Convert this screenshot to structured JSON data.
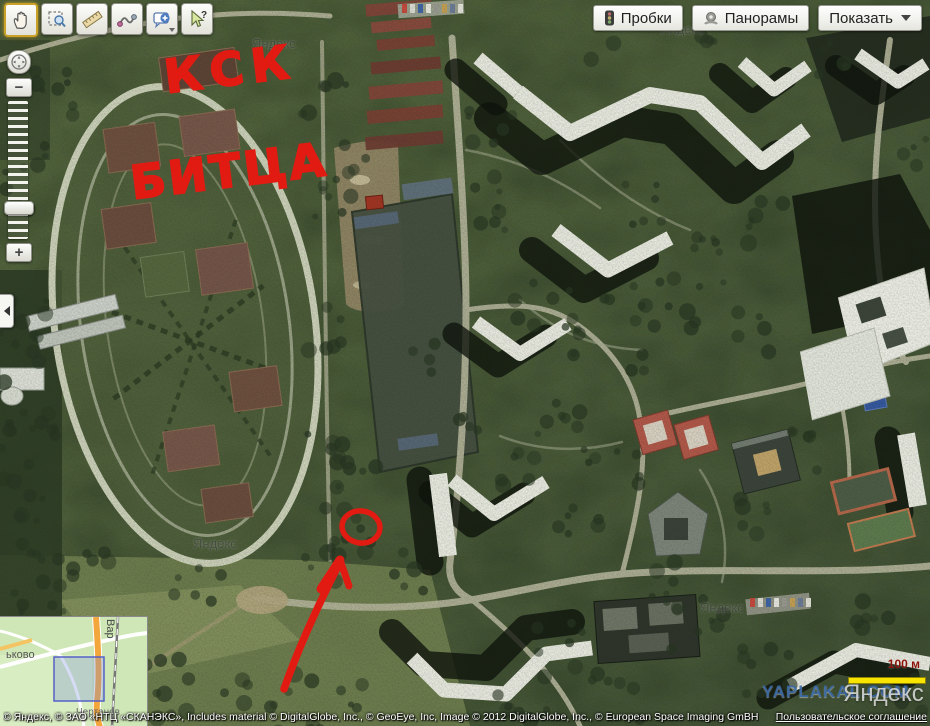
{
  "app": {
    "title": "Яндекс.Карты — спутниковый снимок"
  },
  "toolbar": {
    "tools": [
      {
        "icon": "hand-icon",
        "selected": true
      },
      {
        "icon": "magnifier-select-icon",
        "selected": false
      },
      {
        "icon": "ruler-icon",
        "selected": false
      },
      {
        "icon": "route-icon",
        "selected": false
      },
      {
        "icon": "add-placemark-icon",
        "selected": false,
        "has_dropdown": true
      },
      {
        "icon": "inspector-arrow-icon",
        "selected": false
      }
    ]
  },
  "top_buttons": {
    "traffic": {
      "label": "Пробки",
      "icon": "traffic-light-icon"
    },
    "panoramas": {
      "label": "Панорамы",
      "icon": "panorama-icon"
    },
    "show": {
      "label": "Показать",
      "icon": "dropdown-arrow-icon"
    }
  },
  "zoom_control": {
    "compass_icon": "compass-pan-icon",
    "zoom_out_label": "−",
    "zoom_in_label": "+"
  },
  "annotations": {
    "line1": "КСК",
    "line2": "БИТЦА",
    "shapes": [
      "hand-drawn-circle",
      "hand-drawn-arrow"
    ],
    "color": "#e21b12"
  },
  "watermarks": {
    "yandex_small": "Яндекс",
    "yandex_logo": "Яндекс",
    "site": "YAPLAKAL.COM"
  },
  "scale": {
    "label": "100 м",
    "bar_color": "#f8e400"
  },
  "minimap": {
    "labels": {
      "district_left": "ьково",
      "street_vertical": "Вар",
      "district_bottom": "Чертанов"
    },
    "viewport_color": "#5560c8"
  },
  "attribution": {
    "text": "© Яндекс, © ЗАО «НТЦ «СКАНЭКС», Includes material © DigitalGlobe, Inc., © GeoEye, Inc, Image © 2012 DigitalGlobe, Inc., © European Space Imaging GmBH",
    "link": "Пользовательское соглашение"
  },
  "colors": {
    "annotation_red": "#e21b12",
    "selected_tool_border": "#c9a227",
    "scale_yellow": "#f8e400"
  }
}
